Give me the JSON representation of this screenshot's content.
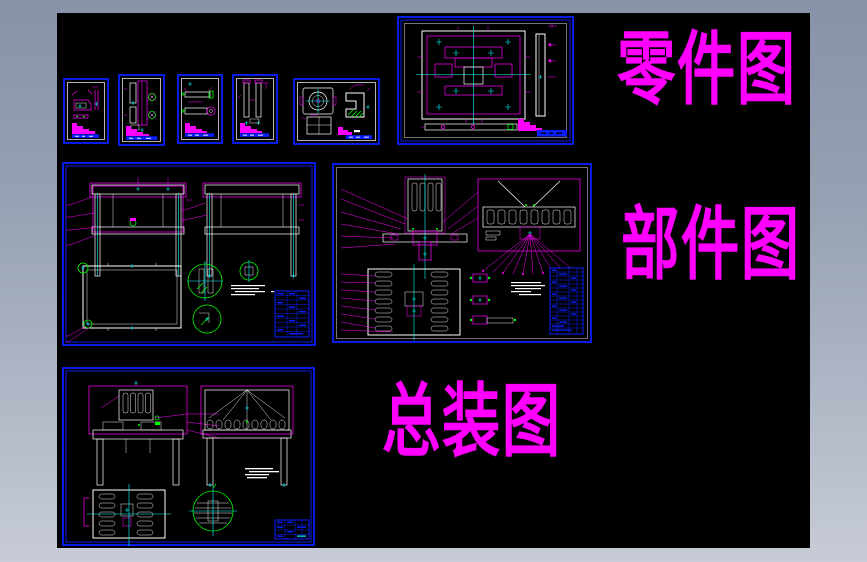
{
  "window": {
    "title": "CAD drawing set preview",
    "background_top": "#8793A9",
    "background_bottom": "#C7CCD7",
    "canvas_color": "#000000"
  },
  "section_labels": {
    "parts": "零件图",
    "components": "部件图",
    "assembly": "总装图"
  },
  "palette": {
    "sheet_border": "#0A1EFF",
    "drawing_magenta": "#FF00FF",
    "centerline_cyan": "#00FFFF",
    "detail_green": "#00FF00",
    "linework_white": "#FFFFFF",
    "label_color": "#FF00FF"
  },
  "sheets": [
    {
      "id": "part-sheet-1",
      "section": "parts"
    },
    {
      "id": "part-sheet-2",
      "section": "parts"
    },
    {
      "id": "part-sheet-3",
      "section": "parts"
    },
    {
      "id": "part-sheet-4",
      "section": "parts"
    },
    {
      "id": "part-sheet-5",
      "section": "parts"
    },
    {
      "id": "part-sheet-6-large",
      "section": "parts"
    },
    {
      "id": "component-sheet-1",
      "section": "components"
    },
    {
      "id": "component-sheet-2",
      "section": "components"
    },
    {
      "id": "assembly-sheet",
      "section": "assembly"
    }
  ]
}
